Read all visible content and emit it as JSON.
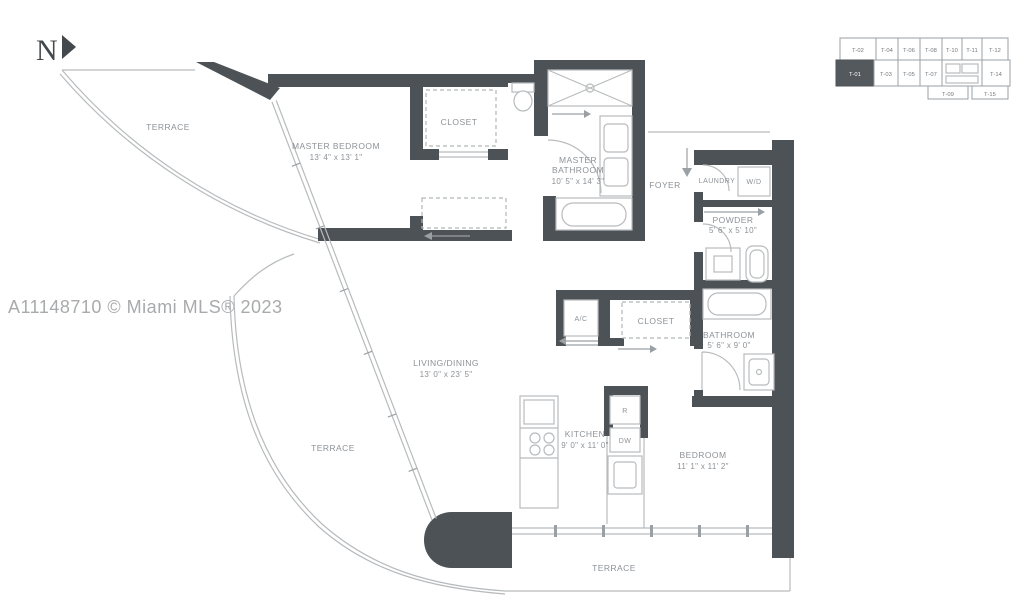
{
  "north_label": "N",
  "watermark": "A11148710 © Miami MLS® 2023",
  "colors": {
    "wall": "#4d5256",
    "thin_line": "#b8bbbd",
    "medium_line": "#9ba0a4",
    "label_text": "#8d9297",
    "watermark_text": "#a8aaac",
    "keyplan_highlight": "#54595d",
    "background": "#ffffff"
  },
  "keyplan": {
    "highlighted_unit": "T-01",
    "units": [
      "T-02",
      "T-04",
      "T-06",
      "T-08",
      "T-10",
      "T-11",
      "T-12",
      "T-01",
      "T-03",
      "T-05",
      "T-07",
      "T-14",
      "T-09",
      "T-15"
    ]
  },
  "rooms": {
    "terrace_top": {
      "name": "TERRACE"
    },
    "master_bedroom": {
      "name": "MASTER BEDROOM",
      "dims": "13' 4\" x 13' 1\""
    },
    "closet_master": {
      "name": "CLOSET"
    },
    "master_bathroom": {
      "name_line1": "MASTER",
      "name_line2": "BATHROOM",
      "dims": "10' 5\" x 14' 3\""
    },
    "foyer": {
      "name": "FOYER"
    },
    "laundry": {
      "name": "LAUNDRY"
    },
    "washer_dryer": {
      "name": "W/D"
    },
    "powder": {
      "name": "POWDER",
      "dims": "5' 6\" x 5' 10\""
    },
    "ac_closet": {
      "name": "A/C"
    },
    "closet_hall": {
      "name": "CLOSET"
    },
    "bathroom": {
      "name": "BATHROOM",
      "dims": "5' 6\" x 9' 0\""
    },
    "living_dining": {
      "name": "LIVING/DINING",
      "dims": "13' 0\" x 23' 5\""
    },
    "terrace_left": {
      "name": "TERRACE"
    },
    "kitchen": {
      "name": "KITCHEN",
      "dims": "9' 0\" x 11' 0\""
    },
    "refrigerator": {
      "name": "R"
    },
    "dishwasher": {
      "name": "DW"
    },
    "bedroom": {
      "name": "BEDROOM",
      "dims": "11' 1\" x 11' 2\""
    },
    "terrace_bottom": {
      "name": "TERRACE"
    }
  }
}
